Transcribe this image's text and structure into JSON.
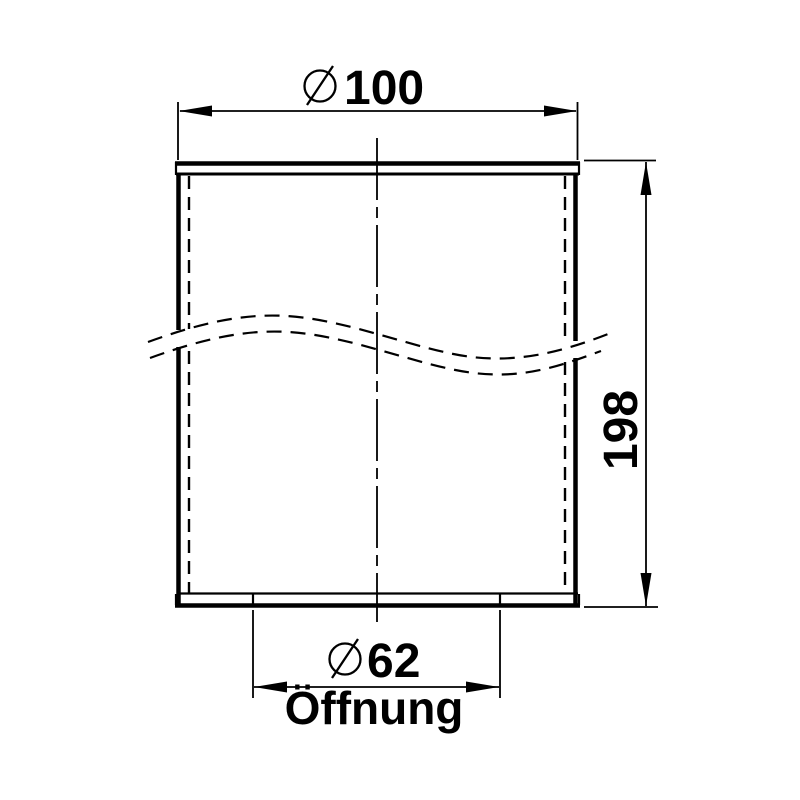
{
  "meta": {
    "description": "Technical dimension drawing of a cylindrical part with break lines",
    "background_color": "#ffffff",
    "line_color": "#000000"
  },
  "labels": {
    "top_diameter": {
      "symbol": "diameter",
      "value": "100"
    },
    "height": {
      "value": "198"
    },
    "opening_diameter": {
      "symbol": "diameter",
      "value": "62"
    },
    "opening_caption": {
      "value": "Öffnung"
    }
  }
}
